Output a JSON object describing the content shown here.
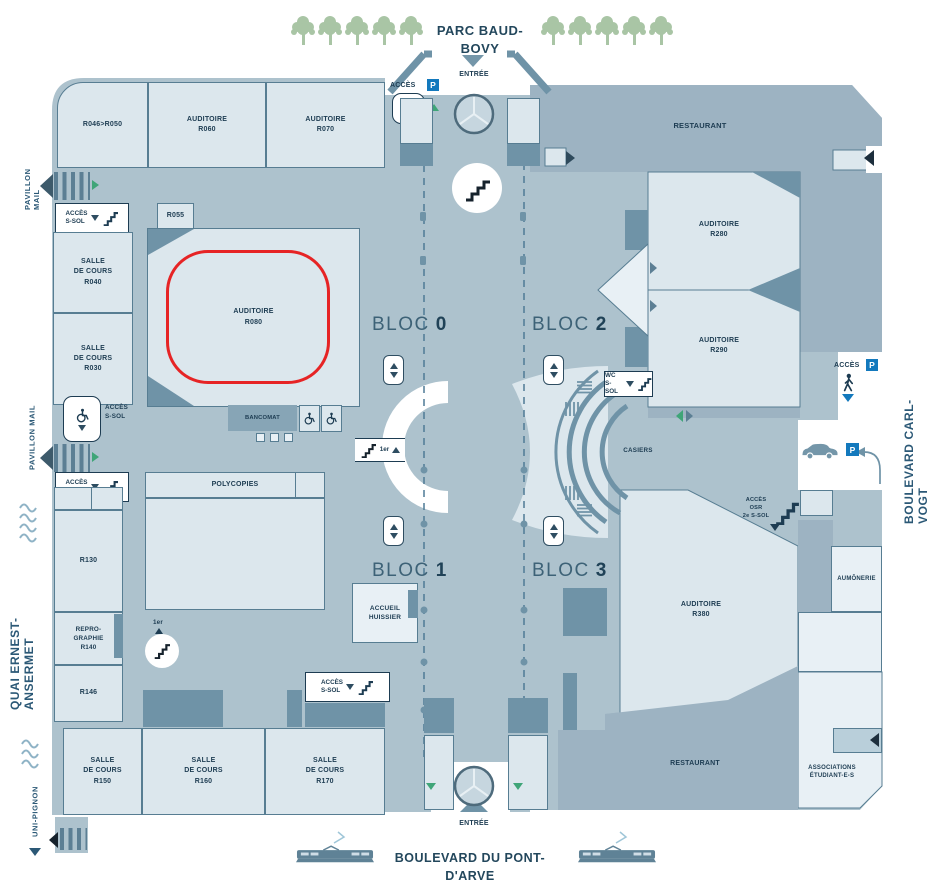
{
  "colors": {
    "corridor": "#adc2cd",
    "room": "#dce7ed",
    "room_bright": "#e8f0f5",
    "dark": "#6f93a7",
    "mid": "#87a5b6",
    "restaurant": "#9db3c2",
    "navy": "#1d3c52",
    "street": "#2b5876",
    "red": "#e62425",
    "green": "#3fa578",
    "tree": "#a9c5a5",
    "p_blue": "#1379bd",
    "wave": "#8fb3c6",
    "dash": "#4f7a95"
  },
  "park": "PARC BAUD-BOVY",
  "streets": {
    "pavillon_mail": "PAVILLON MAIL",
    "quai": "QUAI ERNEST-ANSERMET",
    "uni_pignon": "UNI-PIGNON",
    "carl_vogt": "BOULEVARD CARL-VOGT",
    "pont_darve": "BOULEVARD DU PONT-D'ARVE"
  },
  "entrance": "ENTRÉE",
  "badges": {
    "p": "P"
  },
  "access": {
    "acces": "ACCÈS",
    "s_sol": "ACCÈS\nS-SOL",
    "wc": "WC\nS-SOL",
    "osr": "ACCÈS\nOSR\n2e S-SOL",
    "premier": "1er"
  },
  "blocs": [
    {
      "name": "BLOC",
      "num": "0"
    },
    {
      "name": "BLOC",
      "num": "2"
    },
    {
      "name": "BLOC",
      "num": "1"
    },
    {
      "name": "BLOC",
      "num": "3"
    }
  ],
  "rooms": {
    "r046": "R046>R050",
    "r060": "AUDITOIRE\nR060",
    "r070": "AUDITOIRE\nR070",
    "r055": "R055",
    "r040": "SALLE\nDE COURS\nR040",
    "r030": "SALLE\nDE COURS\nR030",
    "r080": "AUDITOIRE\nR080",
    "r280": "AUDITOIRE\nR280",
    "r290": "AUDITOIRE\nR290",
    "r380": "AUDITOIRE\nR380",
    "polycopies": "POLYCOPIES",
    "r130": "R130",
    "r140": "REPRO-\nGRAPHIE\nR140",
    "r146": "R146",
    "r150": "SALLE\nDE COURS\nR150",
    "r160": "SALLE\nDE COURS\nR160",
    "r170": "SALLE\nDE COURS\nR170",
    "accueil": "ACCUEIL\nHUISSIER",
    "casiers": "CASIERS",
    "bancomat": "BANCOMAT",
    "restaurant": "RESTAURANT",
    "aumonerie": "AUMÔNERIE",
    "associations": "ASSOCIATIONS\nÉTUDIANT-E-S"
  }
}
